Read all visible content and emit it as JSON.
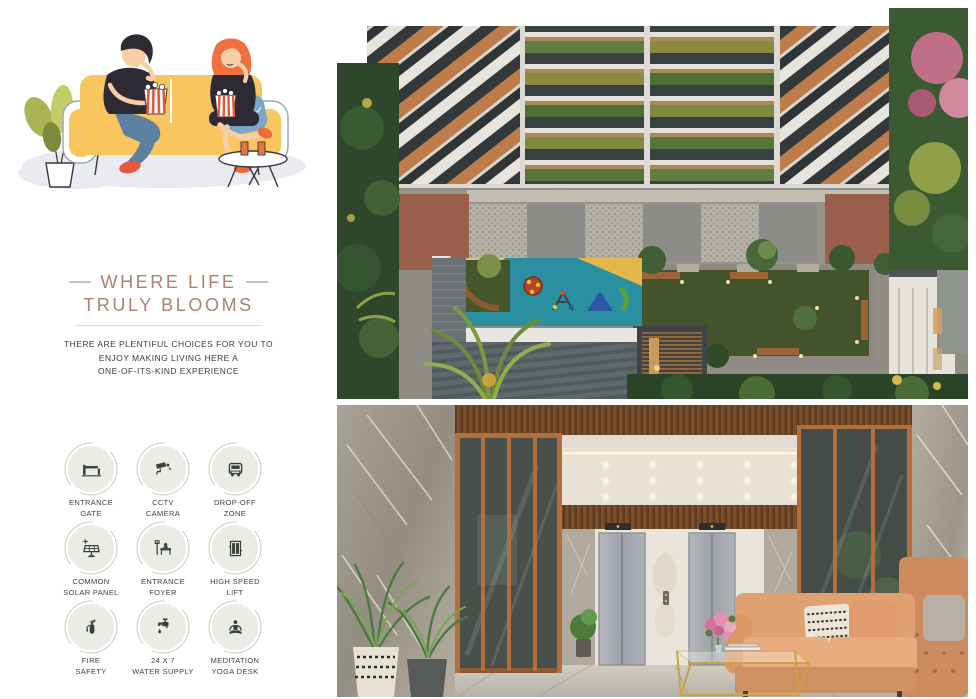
{
  "page": {
    "background": "#ffffff"
  },
  "hero_illustration": {
    "name": "couple-on-yellow-sofa-eating-popcorn-illustration",
    "description": "Flat illustration of a man and woman on a yellow sofa eating popcorn, with plant and side table"
  },
  "section": {
    "heading_line1": "WHERE LIFE",
    "heading_line2": "TRULY BLOOMS",
    "heading_color": "#ad8071",
    "intro_line1": "THERE ARE PLENTIFUL CHOICES FOR YOU TO",
    "intro_line2": "ENJOY MAKING LIVING HERE A",
    "intro_line3": "ONE-OF-ITS-KIND EXPERIENCE"
  },
  "amenities": {
    "items": [
      {
        "icon": "entrance-gate-icon",
        "line1": "ENTRANCE",
        "line2": "GATE"
      },
      {
        "icon": "cctv-camera-icon",
        "line1": "CCTV",
        "line2": "CAMERA"
      },
      {
        "icon": "drop-off-zone-icon",
        "line1": "DROP-OFF",
        "line2": "ZONE"
      },
      {
        "icon": "common-solar-panel-icon",
        "line1": "COMMON",
        "line2": "SOLAR PANEL"
      },
      {
        "icon": "entrance-foyer-icon",
        "line1": "ENTRANCE",
        "line2": "FOYER"
      },
      {
        "icon": "high-speed-lift-icon",
        "line1": "HIGH SPEED",
        "line2": "LIFT"
      },
      {
        "icon": "fire-safety-icon",
        "line1": "FIRE",
        "line2": "SAFETY"
      },
      {
        "icon": "water-supply-icon",
        "line1": "24 X 7",
        "line2": "WATER SUPPLY"
      },
      {
        "icon": "meditation-yoga-desk-icon",
        "line1": "MEDITATION",
        "line2": "YOGA DESK"
      }
    ],
    "circle_color": "#eaece6",
    "glyph_color": "#3a403c"
  },
  "renders": {
    "aerial": {
      "name": "aerial-courtyard-garden-render"
    },
    "lobby": {
      "name": "entrance-lobby-interior-render"
    }
  },
  "colors": {
    "sofa_yellow": "#f9c55e",
    "accent_orange": "#e8763f",
    "jeans_blue": "#5b80a0",
    "lawn_green": "#43532b",
    "play_teal": "#2a8fa0",
    "terracotta": "#9b5f4d",
    "marble_gray": "#a29b8e",
    "wood_brown": "#7a4e2a",
    "sofa_peach": "#dea16f",
    "gold": "#c8a245"
  }
}
